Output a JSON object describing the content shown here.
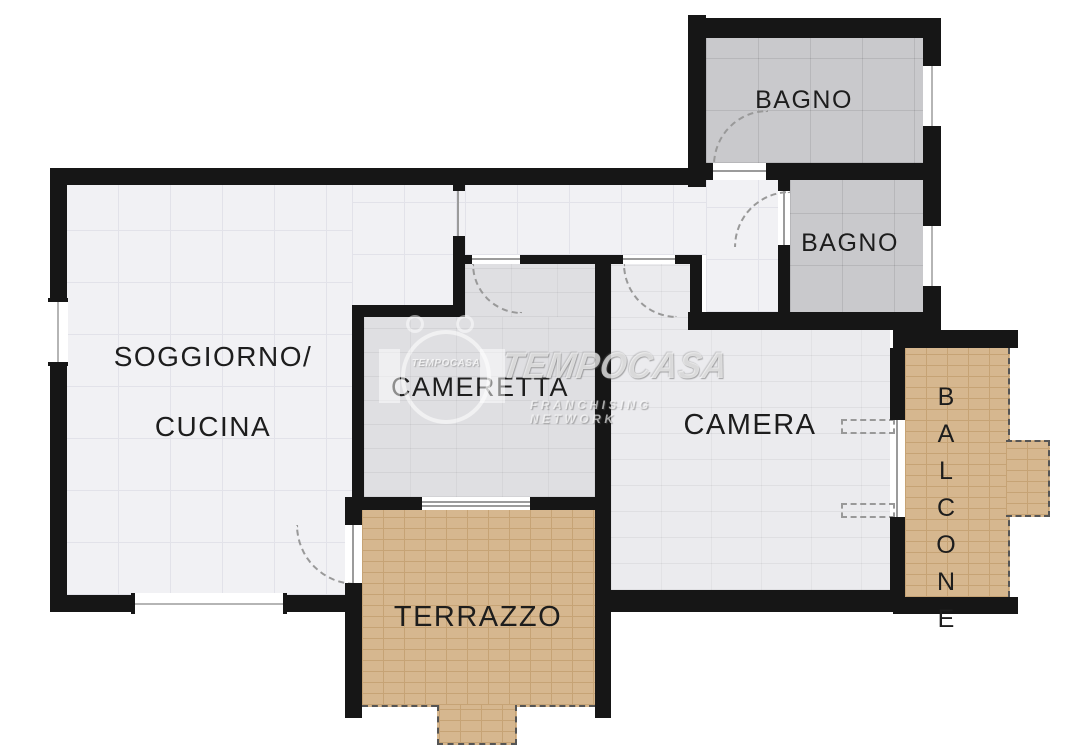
{
  "meta": {
    "type": "apartment-floor-plan",
    "brand": "TEMPOCASA"
  },
  "rooms": {
    "soggiorno": {
      "label_line1": "SOGGIORNO/",
      "label_line2": "CUCINA"
    },
    "cameretta": {
      "label": "CAMERETTA"
    },
    "camera": {
      "label": "CAMERA"
    },
    "bagno_top": {
      "label": "BAGNO"
    },
    "bagno_mid": {
      "label": "BAGNO"
    },
    "terrazzo": {
      "label": "TERRAZZO"
    },
    "balcone": {
      "label": "BALCONE"
    }
  },
  "watermark": {
    "brand": "TEMPOCASA",
    "emblem_text": "TEMPOCASA",
    "subtitle": "FRANCHISING NETWORK"
  },
  "theme": {
    "wall": "#161616",
    "floor-main": "#f1f1f4",
    "grid": "#e2e2e9",
    "floor-cameretta": "#dfdfe2",
    "floor-camera": "#ebebee",
    "floor-bagno": "#c9c9cc",
    "floor-terrace": "#d6b78f",
    "terrace-line": "#c6a375",
    "label": "#1d1d1d",
    "threshold": "#9b9b9b",
    "arc": "#999999",
    "paper": "#ffffff"
  }
}
